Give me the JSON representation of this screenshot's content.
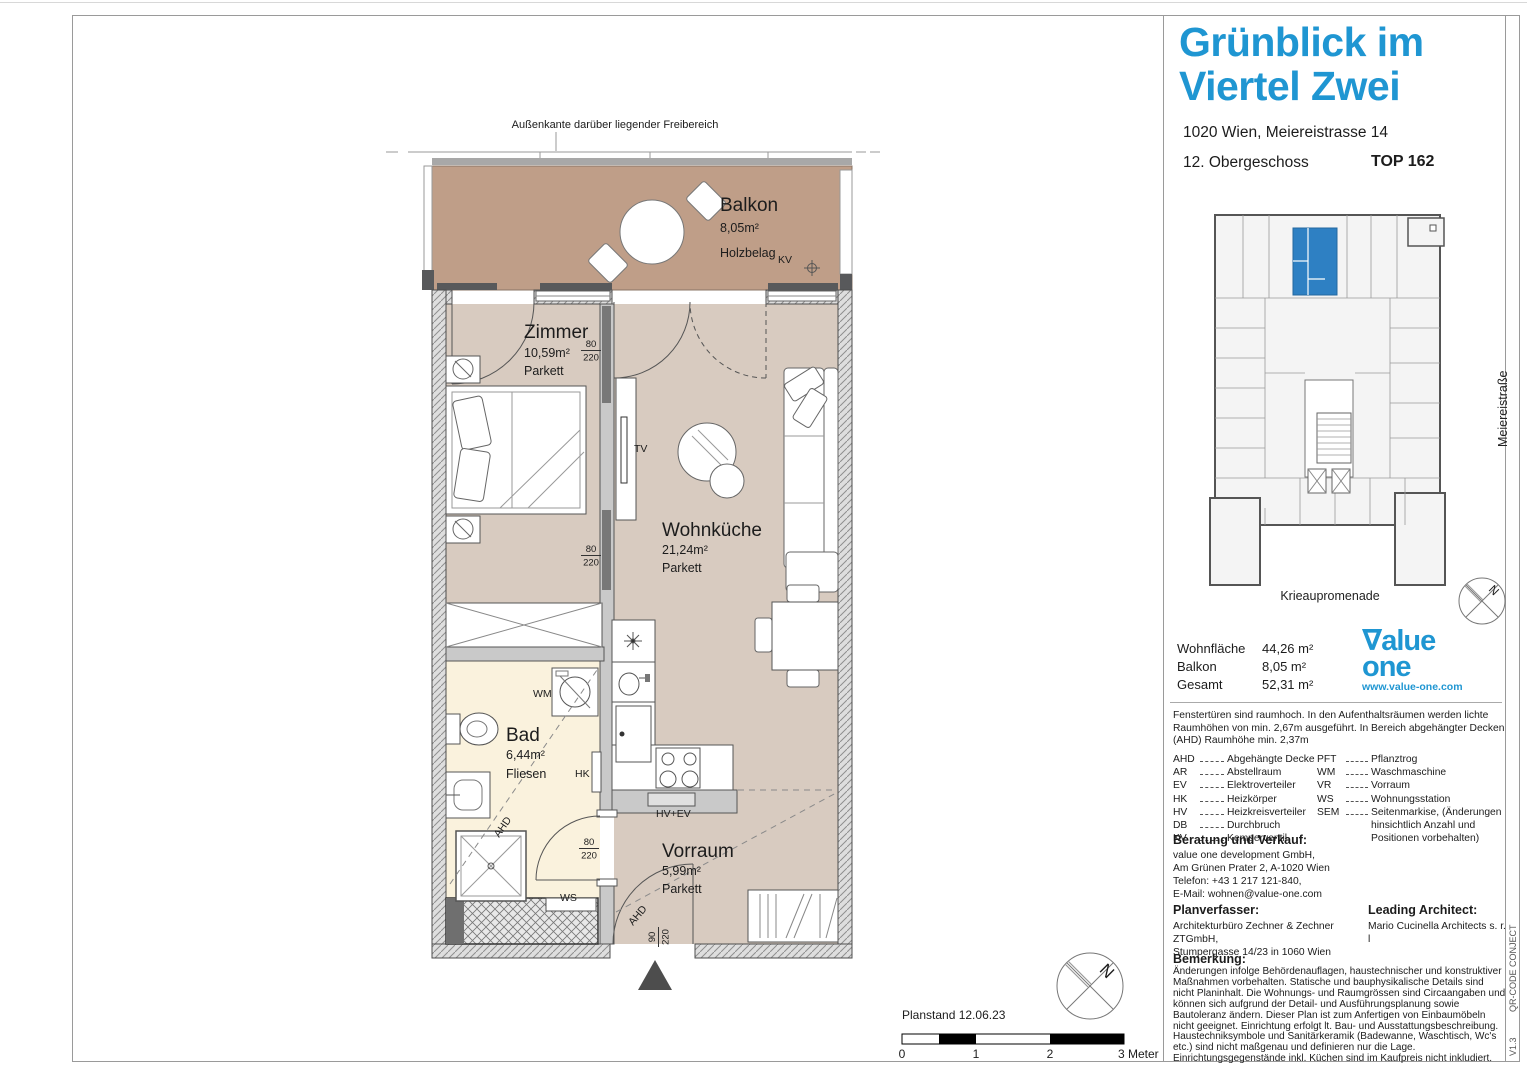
{
  "plan": {
    "outer_edge_label": "Außenkante darüber liegender Freibereich",
    "rooms": {
      "balkon": {
        "name": "Balkon",
        "area": "8,05m²",
        "floor": "Holzbelag"
      },
      "zimmer": {
        "name": "Zimmer",
        "area": "10,59m²",
        "floor": "Parkett"
      },
      "wohnkueche": {
        "name": "Wohnküche",
        "area": "21,24m²",
        "floor": "Parkett"
      },
      "bad": {
        "name": "Bad",
        "area": "6,44m²",
        "floor": "Fliesen"
      },
      "vorraum": {
        "name": "Vorraum",
        "area": "5,99m²",
        "floor": "Parkett"
      }
    },
    "labels": {
      "kv": "KV",
      "tv": "TV",
      "wm": "WM",
      "hk": "HK",
      "ws": "WS",
      "ahd": "AHD",
      "hv_ev": "HV+EV"
    },
    "dims": {
      "standard": {
        "w": "80",
        "h": "220"
      },
      "entry": {
        "w": "90",
        "h": "220"
      }
    },
    "planstand": "Planstand 12.06.23",
    "scale": [
      "0",
      "1",
      "2",
      "3 Meter"
    ],
    "north": "N"
  },
  "sidebar": {
    "title1": "Grünblick im",
    "title2": "Viertel Zwei",
    "address": "1020 Wien, Meiereistrasse 14",
    "floor": "12. Obergeschoss",
    "unit": "TOP 162",
    "keyplan": {
      "street_right": "Meiereistraße",
      "street_bottom": "Krieaupromenade"
    },
    "areas": [
      {
        "label": "Wohnfläche",
        "value": "44,26 m²"
      },
      {
        "label": "Balkon",
        "value": "8,05 m²"
      },
      {
        "label": "Gesamt",
        "value": "52,31 m²"
      }
    ],
    "logo": {
      "mark": "∇",
      "rest": "alue",
      "line2": "one",
      "url": "www.value-one.com"
    },
    "note": "Fenstertüren sind raumhoch. In den Aufenthaltsräumen werden lichte Raumhöhen von min. 2,67m ausgeführt. In Bereich abgehängter Decken (AHD) Raumhöhe min. 2,37m",
    "legend_left": [
      {
        "abbr": "AHD",
        "desc": "Abgehängte Decke"
      },
      {
        "abbr": "AR",
        "desc": "Abstellraum"
      },
      {
        "abbr": "EV",
        "desc": "Elektroverteiler"
      },
      {
        "abbr": "HK",
        "desc": "Heizkörper"
      },
      {
        "abbr": "HV",
        "desc": "Heizkreisverteiler"
      },
      {
        "abbr": "DB",
        "desc": "Durchbruch"
      },
      {
        "abbr": "KV",
        "desc": "Kemperventil"
      }
    ],
    "legend_right": [
      {
        "abbr": "PFT",
        "desc": "Pflanztrog"
      },
      {
        "abbr": "WM",
        "desc": "Waschmaschine"
      },
      {
        "abbr": "VR",
        "desc": "Vorraum"
      },
      {
        "abbr": "WS",
        "desc": "Wohnungsstation"
      },
      {
        "abbr": "SEM",
        "desc": "Seitenmarkise, (Änderungen hinsichtlich Anzahl und Positionen vorbehalten)"
      }
    ],
    "contact": {
      "heading": "Beratung und Verkauf:",
      "lines": [
        "value one development GmbH,",
        "Am Grünen Prater 2, A-1020 Wien",
        "Telefon: +43 1 217 121-840,",
        "E-Mail: wohnen@value-one.com"
      ]
    },
    "planner": {
      "heading": "Planverfasser:",
      "lines": [
        "Architekturbüro Zechner & Zechner ZTGmbH,",
        "Stumpergasse 14/23 in 1060 Wien"
      ]
    },
    "architect": {
      "heading": "Leading Architect:",
      "lines": [
        "Mario Cucinella Architects s. r. l"
      ]
    },
    "remark": {
      "heading": "Bemerkung:",
      "text": "Änderungen infolge Behördenauflagen, haustechnischer und konstruktiver Maßnahmen vorbehalten. Statische und bauphysikalische Details sind nicht Planinhalt. Die Wohnungs- und Raumgrössen sind Circaangaben und können sich aufgrund der Detail- und Ausführungsplanung sowie Bautoleranz ändern. Dieser Plan ist zum Anfertigen von Einbaumöbeln nicht geeignet. Einrichtung erfolgt lt. Bau- und Ausstattungsbeschreibung. Haustechniksymbole und Sanitärkeramik (Badewanne, Waschtisch, Wc's etc.) sind nicht maßgenau und definieren nur die Lage. Einrichtungsgegenstände inkl. Küchen sind im Kaufpreis nicht inkludiert."
    },
    "edge": {
      "qr": "QR-CODE CONJECT",
      "version": "V1.3"
    }
  }
}
